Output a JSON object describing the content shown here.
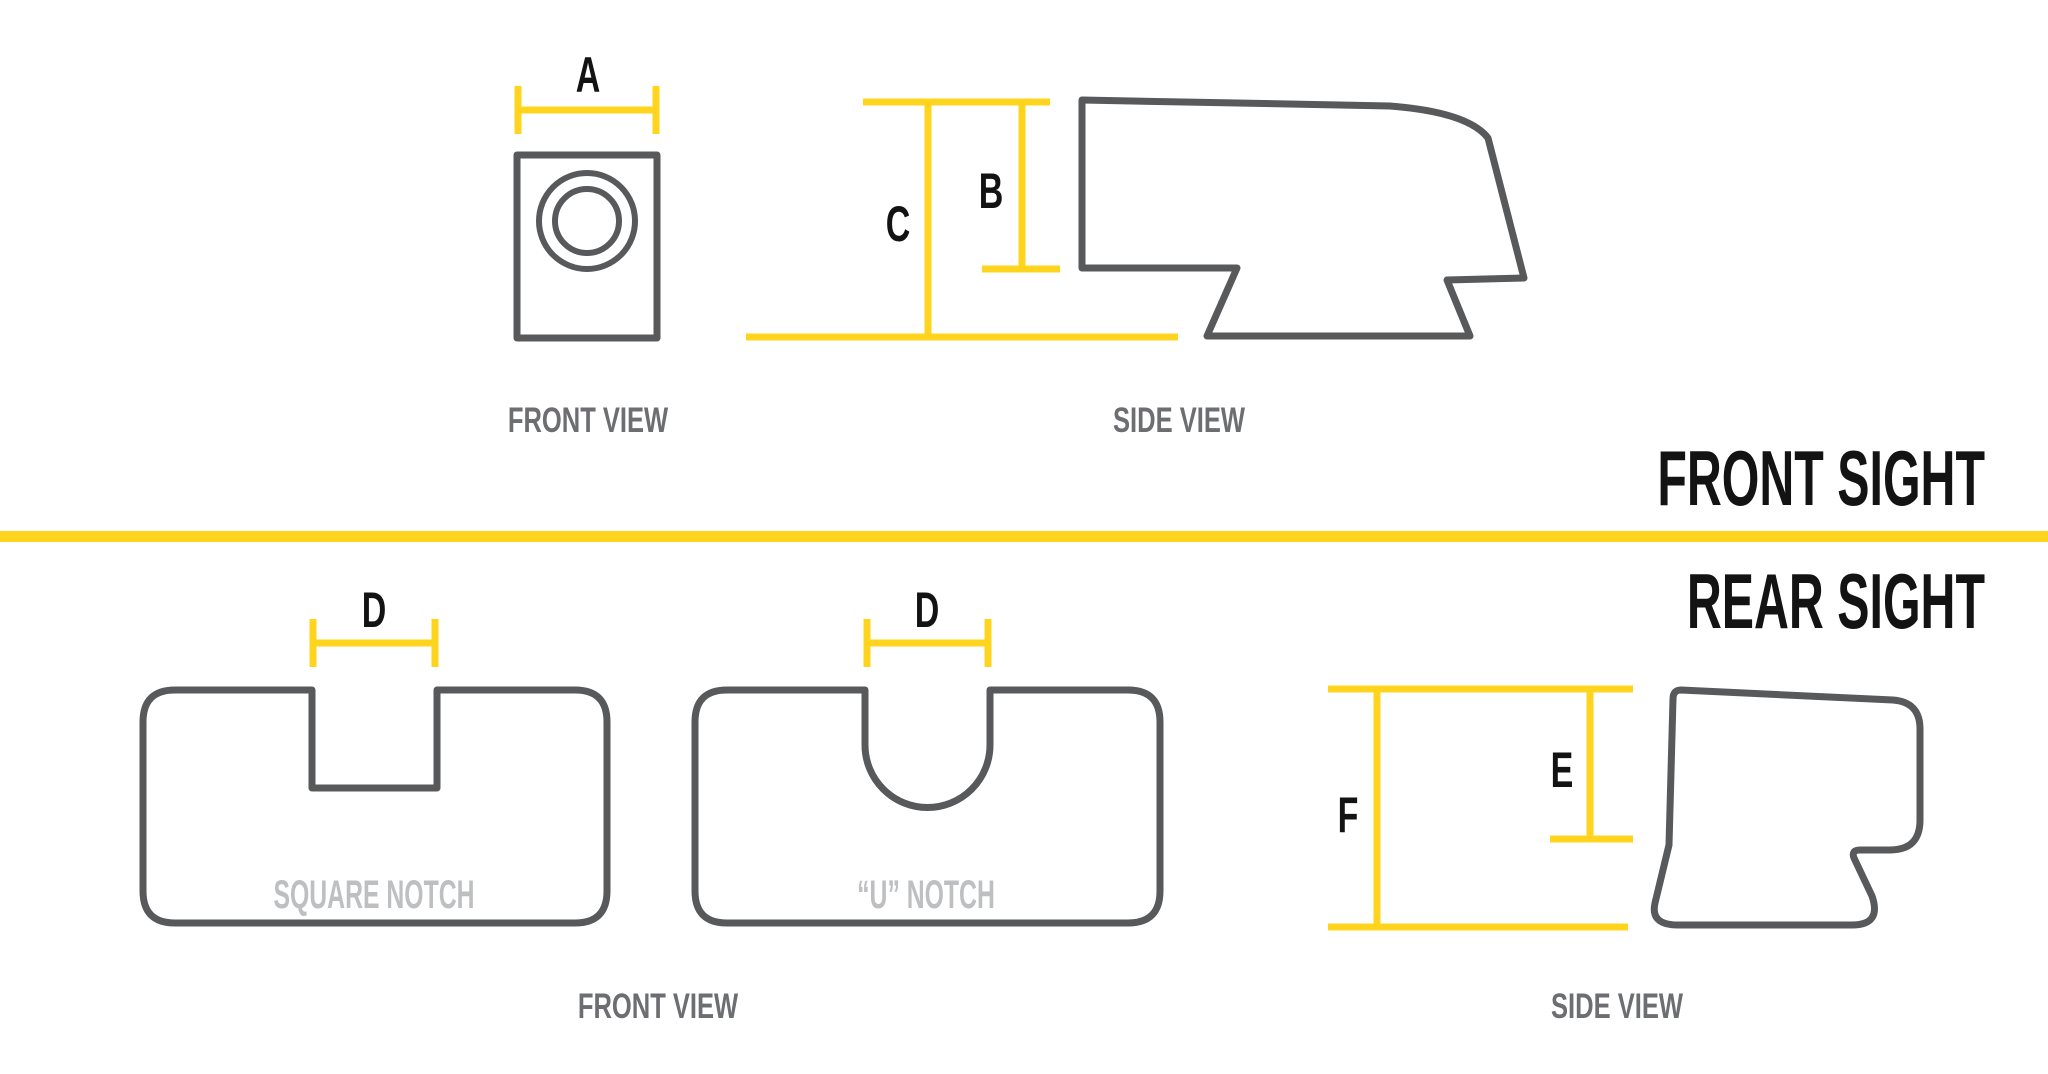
{
  "colors": {
    "accent_yellow": "#ffd41e",
    "outline_gray": "#58595b",
    "view_label_gray": "#6d6e71",
    "caption_light_gray": "#bdbfc1",
    "text_black": "#131313",
    "background": "#ffffff"
  },
  "front_sight": {
    "section_title": "FRONT SIGHT",
    "front_view": {
      "label": "FRONT VIEW",
      "dimension_width": "A"
    },
    "side_view": {
      "label": "SIDE VIEW",
      "dimension_body_height": "B",
      "dimension_total_height": "C"
    }
  },
  "rear_sight": {
    "section_title": "REAR SIGHT",
    "front_view": {
      "label": "FRONT VIEW",
      "square_notch": {
        "caption": "SQUARE NOTCH",
        "dimension_notch_width": "D"
      },
      "u_notch": {
        "caption": "“U” NOTCH",
        "dimension_notch_width": "D"
      }
    },
    "side_view": {
      "label": "SIDE VIEW",
      "dimension_body_height": "E",
      "dimension_total_height": "F"
    }
  }
}
